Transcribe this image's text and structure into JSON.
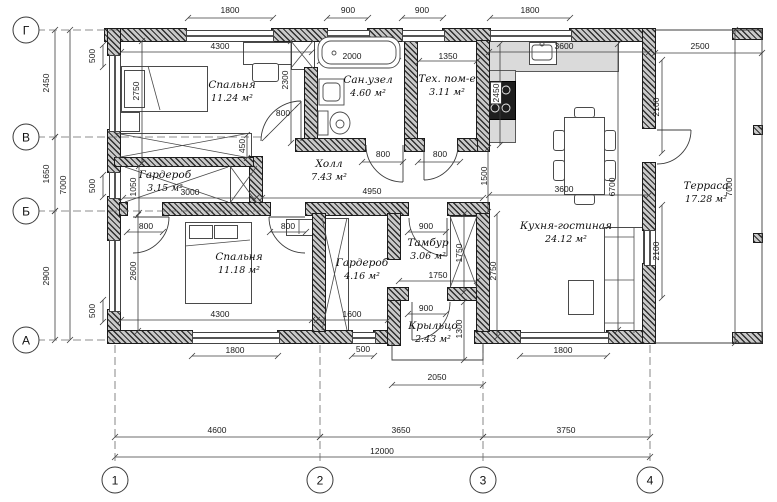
{
  "drawing": {
    "axes": {
      "rows": [
        {
          "label": "Г",
          "x": 26,
          "y": 30
        },
        {
          "label": "В",
          "x": 26,
          "y": 137
        },
        {
          "label": "Б",
          "x": 26,
          "y": 211
        },
        {
          "label": "А",
          "x": 26,
          "y": 340
        }
      ],
      "cols": [
        {
          "label": "1",
          "x": 115,
          "y": 480
        },
        {
          "label": "2",
          "x": 320,
          "y": 480
        },
        {
          "label": "3",
          "x": 483,
          "y": 480
        },
        {
          "label": "4",
          "x": 650,
          "y": 480
        }
      ]
    },
    "rooms": [
      {
        "name": "Спальня",
        "area": "11.24 м²",
        "x": 232,
        "y": 92
      },
      {
        "name": "Сан.узел",
        "area": "4.60 м²",
        "x": 368,
        "y": 87
      },
      {
        "name": "Тех. пом-е",
        "area": "3.11 м²",
        "x": 447,
        "y": 86
      },
      {
        "name": "Холл",
        "area": "7.43 м²",
        "x": 329,
        "y": 171
      },
      {
        "name": "Гардероб",
        "area": "3.15 м²",
        "x": 165,
        "y": 182
      },
      {
        "name": "Спальня",
        "area": "11.18 м²",
        "x": 239,
        "y": 264
      },
      {
        "name": "Гардероб",
        "area": "4.16 м²",
        "x": 362,
        "y": 270
      },
      {
        "name": "Тамбур",
        "area": "3.06 м²",
        "x": 428,
        "y": 250
      },
      {
        "name": "Крыльцо",
        "area": "2.43 м²",
        "x": 433,
        "y": 333
      },
      {
        "name": "Кухня-гостиная",
        "area": "24.12 м²",
        "x": 566,
        "y": 233
      },
      {
        "name": "Терраса",
        "area": "17.28 м²",
        "x": 706,
        "y": 193
      }
    ],
    "dims": [
      {
        "t": "1800",
        "x": 230,
        "y": 10
      },
      {
        "t": "900",
        "x": 348,
        "y": 10
      },
      {
        "t": "900",
        "x": 422,
        "y": 10
      },
      {
        "t": "1800",
        "x": 530,
        "y": 10
      },
      {
        "t": "2500",
        "x": 700,
        "y": 46
      },
      {
        "t": "2450",
        "x": 46,
        "y": 83,
        "r": 1
      },
      {
        "t": "1650",
        "x": 46,
        "y": 174,
        "r": 1
      },
      {
        "t": "2900",
        "x": 46,
        "y": 276,
        "r": 1
      },
      {
        "t": "7000",
        "x": 63,
        "y": 185,
        "r": 1
      },
      {
        "t": "500",
        "x": 92,
        "y": 56,
        "r": 1
      },
      {
        "t": "500",
        "x": 92,
        "y": 186,
        "r": 1
      },
      {
        "t": "500",
        "x": 92,
        "y": 311,
        "r": 1
      },
      {
        "t": "2100",
        "x": 656,
        "y": 107,
        "r": 1
      },
      {
        "t": "2100",
        "x": 656,
        "y": 251,
        "r": 1
      },
      {
        "t": "7000",
        "x": 729,
        "y": 187,
        "r": 1
      },
      {
        "t": "6700",
        "x": 612,
        "y": 187,
        "r": 1
      },
      {
        "t": "1800",
        "x": 235,
        "y": 350
      },
      {
        "t": "500",
        "x": 363,
        "y": 349
      },
      {
        "t": "2050",
        "x": 437,
        "y": 377
      },
      {
        "t": "1800",
        "x": 563,
        "y": 350
      },
      {
        "t": "4600",
        "x": 217,
        "y": 430
      },
      {
        "t": "3650",
        "x": 401,
        "y": 430
      },
      {
        "t": "3750",
        "x": 566,
        "y": 430
      },
      {
        "t": "12000",
        "x": 382,
        "y": 451
      },
      {
        "t": "4300",
        "x": 220,
        "y": 46
      },
      {
        "t": "2300",
        "x": 285,
        "y": 80,
        "r": 1
      },
      {
        "t": "800",
        "x": 283,
        "y": 113
      },
      {
        "t": "2750",
        "x": 136,
        "y": 91,
        "r": 1
      },
      {
        "t": "450",
        "x": 242,
        "y": 146,
        "r": 1
      },
      {
        "t": "2000",
        "x": 352,
        "y": 56
      },
      {
        "t": "1350",
        "x": 448,
        "y": 56
      },
      {
        "t": "3600",
        "x": 564,
        "y": 46
      },
      {
        "t": "2450",
        "x": 496,
        "y": 93,
        "r": 1,
        "bg": 1
      },
      {
        "t": "800",
        "x": 383,
        "y": 154
      },
      {
        "t": "800",
        "x": 440,
        "y": 154
      },
      {
        "t": "4950",
        "x": 372,
        "y": 191
      },
      {
        "t": "1500",
        "x": 484,
        "y": 176,
        "r": 1
      },
      {
        "t": "1050",
        "x": 133,
        "y": 187,
        "r": 1
      },
      {
        "t": "3000",
        "x": 190,
        "y": 192
      },
      {
        "t": "800",
        "x": 146,
        "y": 226
      },
      {
        "t": "800",
        "x": 288,
        "y": 226
      },
      {
        "t": "1600",
        "x": 352,
        "y": 314
      },
      {
        "t": "4300",
        "x": 220,
        "y": 314
      },
      {
        "t": "2600",
        "x": 133,
        "y": 271,
        "r": 1
      },
      {
        "t": "900",
        "x": 426,
        "y": 226
      },
      {
        "t": "1750",
        "x": 438,
        "y": 275
      },
      {
        "t": "1750",
        "x": 459,
        "y": 253,
        "r": 1
      },
      {
        "t": "2750",
        "x": 493,
        "y": 271,
        "r": 1
      },
      {
        "t": "900",
        "x": 426,
        "y": 308
      },
      {
        "t": "1300",
        "x": 459,
        "y": 329,
        "r": 1
      },
      {
        "t": "3600",
        "x": 564,
        "y": 189
      }
    ]
  }
}
